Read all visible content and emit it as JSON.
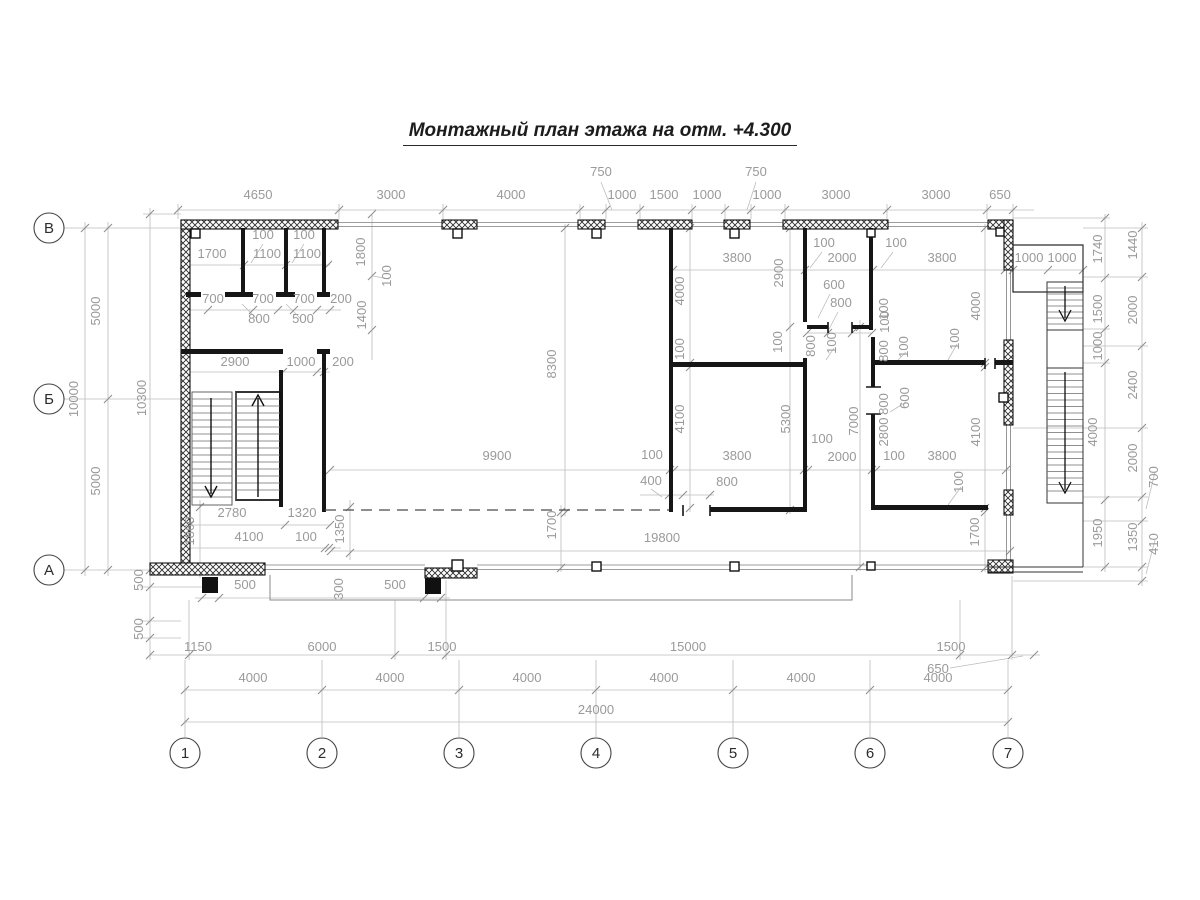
{
  "title": "Монтажный план этажа на отм. +4.300",
  "axes": {
    "rows": [
      {
        "label": "В",
        "x": 49,
        "y": 228
      },
      {
        "label": "Б",
        "x": 49,
        "y": 399
      },
      {
        "label": "А",
        "x": 49,
        "y": 570
      }
    ],
    "cols": [
      {
        "label": "1",
        "x": 185,
        "y": 753
      },
      {
        "label": "2",
        "x": 322,
        "y": 753
      },
      {
        "label": "3",
        "x": 459,
        "y": 753
      },
      {
        "label": "4",
        "x": 596,
        "y": 753
      },
      {
        "label": "5",
        "x": 733,
        "y": 753
      },
      {
        "label": "6",
        "x": 870,
        "y": 753
      },
      {
        "label": "7",
        "x": 1008,
        "y": 753
      }
    ]
  },
  "dim_labels": [
    {
      "t": "4650",
      "x": 258,
      "y": 199
    },
    {
      "t": "3000",
      "x": 391,
      "y": 199
    },
    {
      "t": "4000",
      "x": 511,
      "y": 199
    },
    {
      "t": "750",
      "x": 601,
      "y": 176
    },
    {
      "t": "1000",
      "x": 622,
      "y": 199
    },
    {
      "t": "1500",
      "x": 664,
      "y": 199
    },
    {
      "t": "1000",
      "x": 707,
      "y": 199
    },
    {
      "t": "750",
      "x": 756,
      "y": 176
    },
    {
      "t": "1000",
      "x": 767,
      "y": 199
    },
    {
      "t": "3000",
      "x": 836,
      "y": 199
    },
    {
      "t": "3000",
      "x": 936,
      "y": 199
    },
    {
      "t": "650",
      "x": 1000,
      "y": 199
    },
    {
      "t": "100",
      "x": 263,
      "y": 239
    },
    {
      "t": "100",
      "x": 304,
      "y": 239
    },
    {
      "t": "1700",
      "x": 212,
      "y": 258
    },
    {
      "t": "1100",
      "x": 267,
      "y": 258
    },
    {
      "t": "1100",
      "x": 307,
      "y": 258
    },
    {
      "t": "700",
      "x": 213,
      "y": 303
    },
    {
      "t": "700",
      "x": 263,
      "y": 303
    },
    {
      "t": "700",
      "x": 304,
      "y": 303
    },
    {
      "t": "200",
      "x": 341,
      "y": 303
    },
    {
      "t": "800",
      "x": 259,
      "y": 323
    },
    {
      "t": "500",
      "x": 303,
      "y": 323
    },
    {
      "t": "2900",
      "x": 235,
      "y": 366
    },
    {
      "t": "1000",
      "x": 301,
      "y": 366
    },
    {
      "t": "200",
      "x": 343,
      "y": 366
    },
    {
      "t": "1800",
      "x": 365,
      "y": 252,
      "r": -90
    },
    {
      "t": "100",
      "x": 391,
      "y": 276,
      "r": -90
    },
    {
      "t": "1400",
      "x": 366,
      "y": 315,
      "r": -90
    },
    {
      "t": "2780",
      "x": 232,
      "y": 517
    },
    {
      "t": "1320",
      "x": 302,
      "y": 517
    },
    {
      "t": "4100",
      "x": 249,
      "y": 541
    },
    {
      "t": "100",
      "x": 306,
      "y": 541
    },
    {
      "t": "1860",
      "x": 194,
      "y": 531,
      "r": -90
    },
    {
      "t": "1350",
      "x": 344,
      "y": 529,
      "r": -90
    },
    {
      "t": "8300",
      "x": 556,
      "y": 364,
      "r": -90
    },
    {
      "t": "9900",
      "x": 497,
      "y": 460
    },
    {
      "t": "1700",
      "x": 556,
      "y": 525,
      "r": -90
    },
    {
      "t": "19800",
      "x": 662,
      "y": 542
    },
    {
      "t": "3800",
      "x": 737,
      "y": 262
    },
    {
      "t": "100",
      "x": 824,
      "y": 247
    },
    {
      "t": "2000",
      "x": 842,
      "y": 262
    },
    {
      "t": "100",
      "x": 896,
      "y": 247
    },
    {
      "t": "3800",
      "x": 942,
      "y": 262
    },
    {
      "t": "1000",
      "x": 1029,
      "y": 262
    },
    {
      "t": "1000",
      "x": 1062,
      "y": 262
    },
    {
      "t": "2900",
      "x": 783,
      "y": 273,
      "r": -90
    },
    {
      "t": "4000",
      "x": 684,
      "y": 291,
      "r": -90
    },
    {
      "t": "4000",
      "x": 980,
      "y": 306,
      "r": -90
    },
    {
      "t": "600",
      "x": 834,
      "y": 289
    },
    {
      "t": "800",
      "x": 841,
      "y": 307
    },
    {
      "t": "100",
      "x": 782,
      "y": 342,
      "r": -90
    },
    {
      "t": "800",
      "x": 815,
      "y": 346,
      "r": -90
    },
    {
      "t": "100",
      "x": 836,
      "y": 343,
      "r": -90
    },
    {
      "t": "100",
      "x": 889,
      "y": 322,
      "r": -90
    },
    {
      "t": "800",
      "x": 888,
      "y": 351,
      "r": -90
    },
    {
      "t": "100",
      "x": 908,
      "y": 347,
      "r": -90
    },
    {
      "t": "100",
      "x": 888,
      "y": 309,
      "r": -90
    },
    {
      "t": "100",
      "x": 959,
      "y": 339,
      "r": -90
    },
    {
      "t": "100",
      "x": 684,
      "y": 349,
      "r": -90
    },
    {
      "t": "4100",
      "x": 684,
      "y": 419,
      "r": -90
    },
    {
      "t": "5300",
      "x": 790,
      "y": 419,
      "r": -90
    },
    {
      "t": "7000",
      "x": 858,
      "y": 421,
      "r": -90
    },
    {
      "t": "600",
      "x": 909,
      "y": 398,
      "r": -90
    },
    {
      "t": "800",
      "x": 888,
      "y": 404,
      "r": -90
    },
    {
      "t": "2800",
      "x": 888,
      "y": 432,
      "r": -90
    },
    {
      "t": "4100",
      "x": 980,
      "y": 432,
      "r": -90
    },
    {
      "t": "100",
      "x": 652,
      "y": 459
    },
    {
      "t": "3800",
      "x": 737,
      "y": 460
    },
    {
      "t": "100",
      "x": 822,
      "y": 443
    },
    {
      "t": "2000",
      "x": 842,
      "y": 461
    },
    {
      "t": "100",
      "x": 894,
      "y": 460
    },
    {
      "t": "3800",
      "x": 942,
      "y": 460
    },
    {
      "t": "400",
      "x": 651,
      "y": 485
    },
    {
      "t": "800",
      "x": 727,
      "y": 486
    },
    {
      "t": "100",
      "x": 963,
      "y": 482,
      "r": -90
    },
    {
      "t": "1700",
      "x": 979,
      "y": 532,
      "r": -90
    },
    {
      "t": "1740",
      "x": 1102,
      "y": 249,
      "r": -90
    },
    {
      "t": "1500",
      "x": 1102,
      "y": 309,
      "r": -90
    },
    {
      "t": "1000",
      "x": 1102,
      "y": 346,
      "r": -90
    },
    {
      "t": "4000",
      "x": 1097,
      "y": 432,
      "r": -90
    },
    {
      "t": "1950",
      "x": 1102,
      "y": 533,
      "r": -90
    },
    {
      "t": "1440",
      "x": 1137,
      "y": 245,
      "r": -90
    },
    {
      "t": "2000",
      "x": 1137,
      "y": 310,
      "r": -90
    },
    {
      "t": "2400",
      "x": 1137,
      "y": 385,
      "r": -90
    },
    {
      "t": "2000",
      "x": 1137,
      "y": 458,
      "r": -90
    },
    {
      "t": "700",
      "x": 1158,
      "y": 477,
      "r": -90
    },
    {
      "t": "1350",
      "x": 1137,
      "y": 537,
      "r": -90
    },
    {
      "t": "410",
      "x": 1158,
      "y": 544,
      "r": -90
    },
    {
      "t": "5000",
      "x": 100,
      "y": 311,
      "r": -90
    },
    {
      "t": "10000",
      "x": 78,
      "y": 399,
      "r": -90
    },
    {
      "t": "5000",
      "x": 100,
      "y": 481,
      "r": -90
    },
    {
      "t": "10300",
      "x": 146,
      "y": 398,
      "r": -90
    },
    {
      "t": "500",
      "x": 143,
      "y": 580,
      "r": -90
    },
    {
      "t": "500",
      "x": 143,
      "y": 629,
      "r": -90
    },
    {
      "t": "500",
      "x": 245,
      "y": 589
    },
    {
      "t": "300",
      "x": 343,
      "y": 589,
      "r": -90
    },
    {
      "t": "500",
      "x": 395,
      "y": 589
    },
    {
      "t": "1150",
      "x": 198,
      "y": 651
    },
    {
      "t": "6000",
      "x": 322,
      "y": 651
    },
    {
      "t": "1500",
      "x": 442,
      "y": 651
    },
    {
      "t": "15000",
      "x": 688,
      "y": 651
    },
    {
      "t": "1500",
      "x": 951,
      "y": 651
    },
    {
      "t": "650",
      "x": 938,
      "y": 673
    },
    {
      "t": "4000",
      "x": 253,
      "y": 682
    },
    {
      "t": "4000",
      "x": 390,
      "y": 682
    },
    {
      "t": "4000",
      "x": 527,
      "y": 682
    },
    {
      "t": "4000",
      "x": 664,
      "y": 682
    },
    {
      "t": "4000",
      "x": 801,
      "y": 682
    },
    {
      "t": "4000",
      "x": 938,
      "y": 682
    },
    {
      "t": "24000",
      "x": 596,
      "y": 714
    }
  ]
}
